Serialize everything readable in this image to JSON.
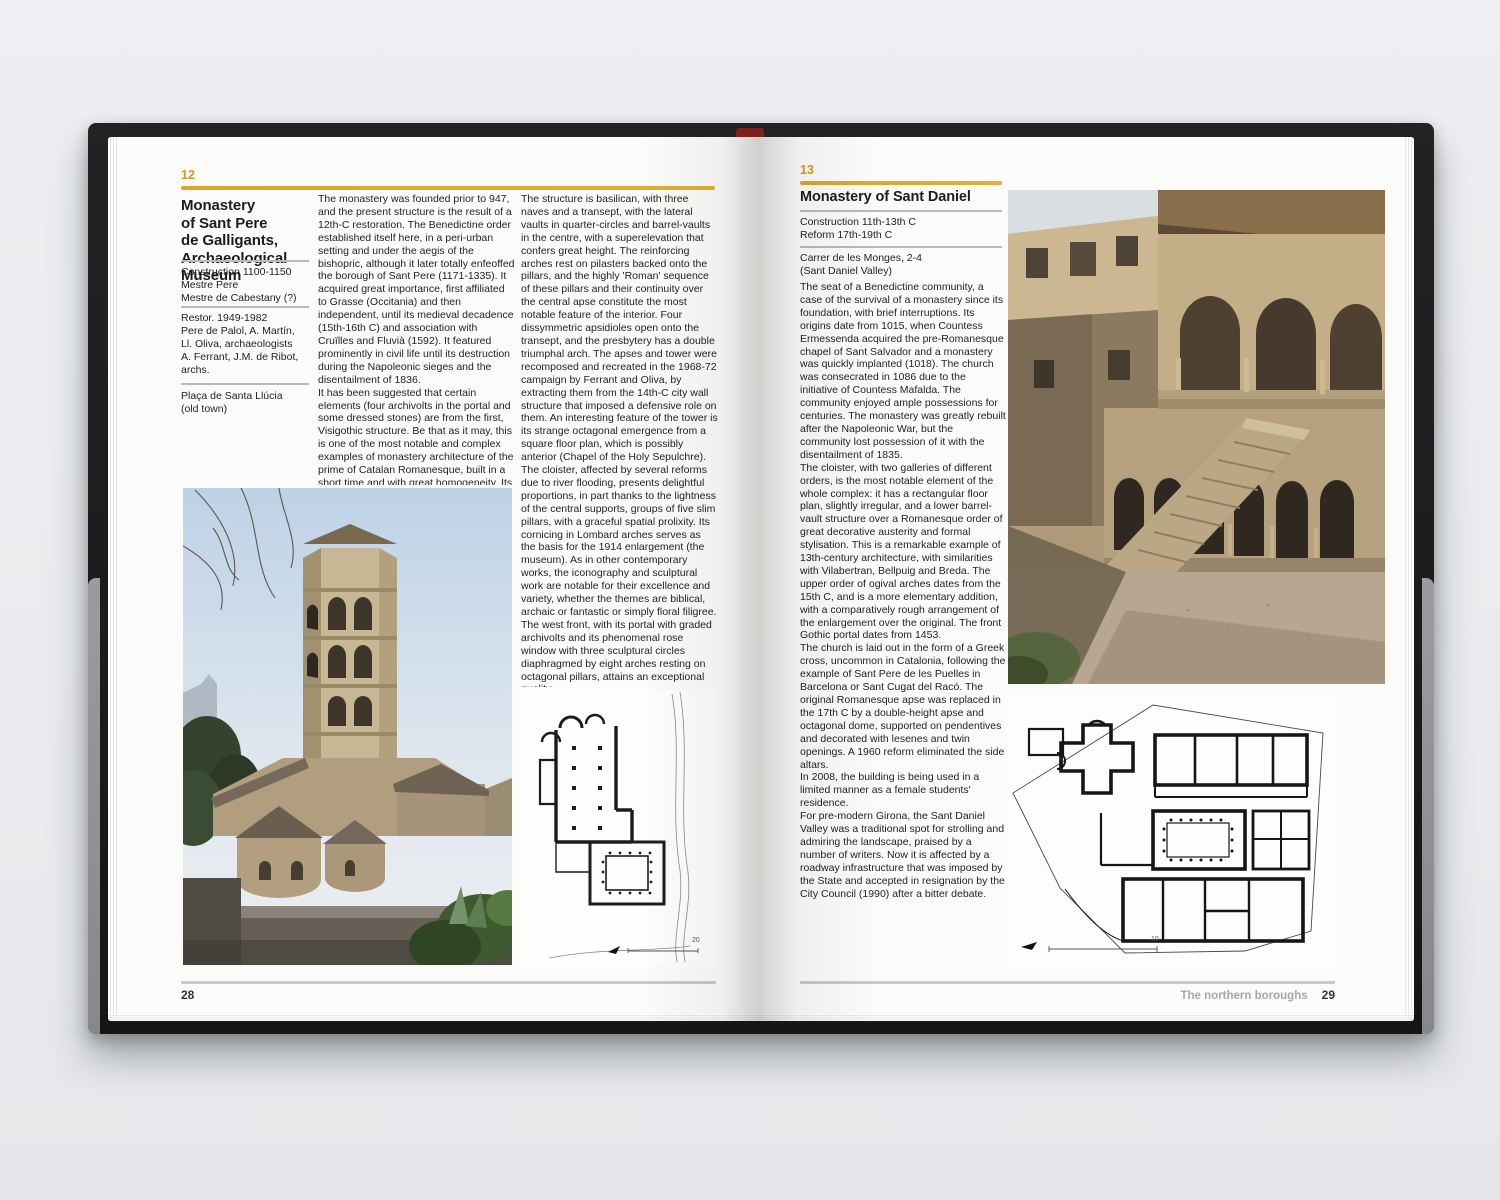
{
  "colors": {
    "accent_gold": "#d9a226",
    "text": "#232323",
    "rule_gray": "#b7b9bb",
    "footer_gray": "#a5a7a9"
  },
  "book": {
    "left": {
      "num": "12",
      "title": "Monastery\nof Sant Pere\nde Galligants,\nArchaeological\nMuseum",
      "construction": "Construction 1100-1150\nMestre Pere\nMestre de Cabestany (?)",
      "restoration": "Restor. 1949-1982\nPere de Palol, A. Martín,\nLl. Oliva, archaeologists\nA. Ferrant, J.M. de Ribot,\narchs.",
      "address": "Plaça de Santa Llúcia\n(old town)",
      "col2": {
        "p1": "The monastery was founded prior to 947, and the present structure is the result of a 12th-C restoration. The Benedictine order established itself here, in a peri-urban setting and under the aegis of the bishopric, although it later totally enfeoffed the borough of Sant Pere (1171-1335). It acquired great importance, first affiliated to Grasse (Occitania) and then independent, until its medieval decadence (15th-16th C) and association with Cruïlles and Fluvià (1592). It featured prominently in civil life until its destruction during the Napoleonic sieges and the disentailment of 1836.",
        "p2": "It has been suggested that certain elements (four archivolts in the portal and some dressed stones) are from the first, Visigothic structure. Be that as it may, this is one of the most notable and complex examples of monastery architecture of the prime of Catalan Romanesque, built in a short time and with great homogeneity. Its similarity with the cloister of Girona's own Cathedral, with Sant Pere de Rodes or with Sant Cugat, meant that it participated in the finest artistic production of those times."
      },
      "col3": {
        "p1": "The structure is basilican, with three naves and a transept, with the lateral vaults in quarter-circles and barrel-vaults in the centre, with a superelevation that confers great height. The reinforcing arches rest on pilasters backed onto the pillars, and the highly 'Roman' sequence of these pillars and their continuity over the central apse constitute the most notable feature of the interior. Four dissymmetric apsidioles open onto the transept, and the presbytery has a double triumphal arch. The apses and tower were recomposed and recreated in the 1968-72 campaign by Ferrant and Oliva, by extracting them from the 14th-C city wall structure that imposed a defensive role on them. An interesting feature of the tower is its strange octagonal emergence from a square floor plan, which is possibly anterior (Chapel of the Holy Sepulchre).",
        "p2": "The cloister, affected by several reforms due to river flooding, presents delightful proportions, in part thanks to the lightness of the central supports, groups of five slim pillars, with a graceful spatial prolixity. Its cornicing in Lombard arches serves as the basis for the 1914 enlargement (the museum). As in other contemporary works, the iconography and sculptural work are notable for their excellence and variety, whether the themes are biblical, archaic or fantastic or simply floral filigree.",
        "p3": "The west front, with its portal with graded archivolts and its phenomenal rose window with three sculptural circles diaphragmed by eight arches resting on octagonal pillars, attains an exceptional quality.",
        "p4": "Nearby, see the Geli House (Santa Llúcia, 12), rehabilitated (1997-2000) by Adrià Felip with a highly organic insertion of the new programme into the existing structure and courtyard."
      },
      "plan_scale": "20",
      "page_number": "28"
    },
    "right": {
      "num": "13",
      "title": "Monastery of Sant Daniel",
      "construction": "Construction 11th-13th C\nReform 17th-19th C",
      "address": "Carrer de les Monges, 2-4\n(Sant Daniel Valley)",
      "body": {
        "p1": "The seat of a Benedictine community, a case of the survival of a monastery since its foundation, with brief interruptions. Its origins date from 1015, when Countess Ermessenda acquired the pre-Romanesque chapel of Sant Salvador and a monastery was quickly implanted (1018). The church was consecrated in 1086 due to the initiative of Countess Mafalda. The community enjoyed ample possessions for centuries. The monastery was greatly rebuilt after the Napoleonic War, but the community lost possession of it with the disentailment of 1835.",
        "p2": "The cloister, with two galleries of different orders, is the most notable element of the whole complex: it has a rectangular floor plan, slightly irregular, and a lower barrel-vault structure over a Romanesque order of great decorative austerity and formal stylisation. This is a remarkable example of 13th-century architecture, with similarities with Vilabertran, Bellpuig and Breda. The upper order of ogival arches dates from the 15th C, and is a more elementary addition, with a comparatively rough arrangement of the enlargement over the original. The front Gothic portal dates from 1453.",
        "p3": "The church is laid out in the form of a Greek cross, uncommon in Catalonia, following the example of Sant Pere de les Puelles in Barcelona or Sant Cugat del Racó. The original Romanesque apse was replaced in the 17th C by a double-height apse and octagonal dome, supported on pendentives and decorated with lesenes and twin openings. A 1960 reform eliminated the side altars.",
        "p4": "In 2008, the building is being used in a limited manner as a female students' residence.",
        "p5": "For pre-modern Girona, the Sant Daniel Valley was a traditional spot for strolling and admiring the landscape, praised by a number of writers. Now it is affected by a roadway infrastructure that was imposed by the State and accepted in resignation by the City Council (1990) after a bitter debate."
      },
      "plan_scale": "10",
      "footer_section": "The northern boroughs",
      "page_number": "29"
    }
  }
}
